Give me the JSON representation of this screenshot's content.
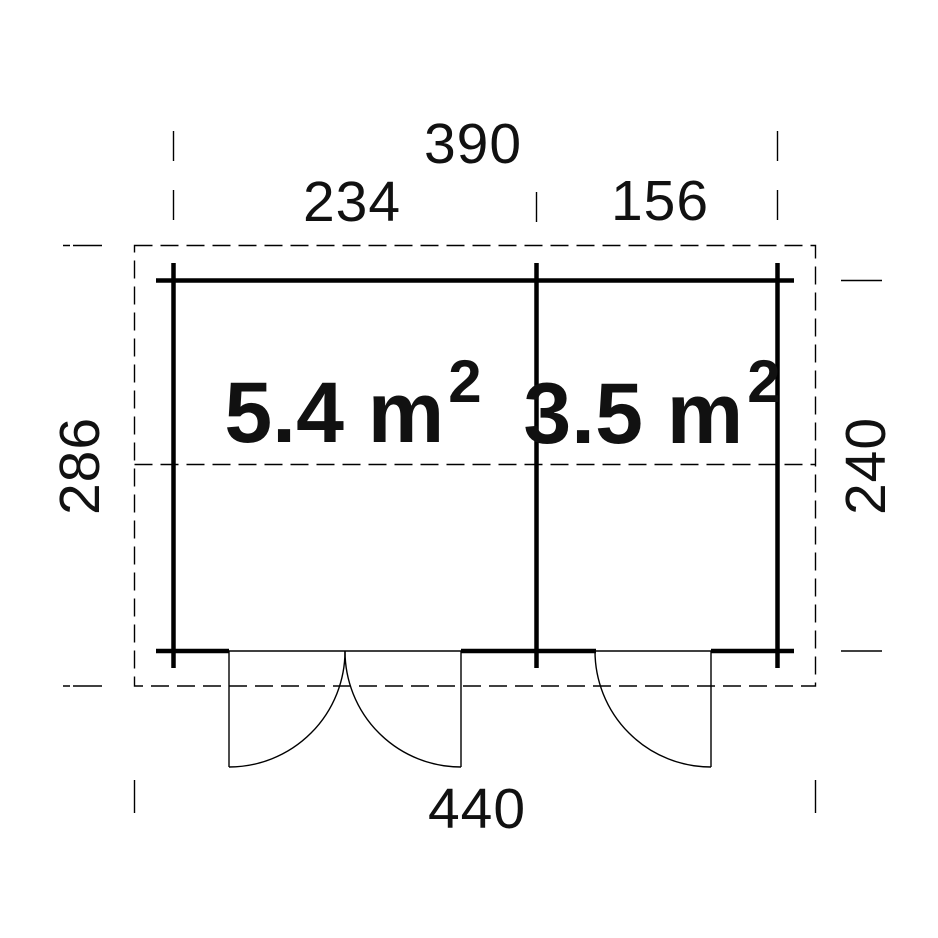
{
  "page": {
    "background_color": "#ffffff",
    "line_color": "#000000",
    "text_color": "#111111"
  },
  "drawing": {
    "type": "floor-plan",
    "dimensions": {
      "top_total": "390",
      "top_left_segment": "234",
      "top_right_segment": "156",
      "left_height": "286",
      "right_height": "240",
      "bottom_total": "440"
    },
    "rooms": [
      {
        "name": "left-room",
        "label": "5.4 m",
        "exponent": "2"
      },
      {
        "name": "right-room",
        "label": "3.5 m",
        "exponent": "2"
      }
    ]
  }
}
